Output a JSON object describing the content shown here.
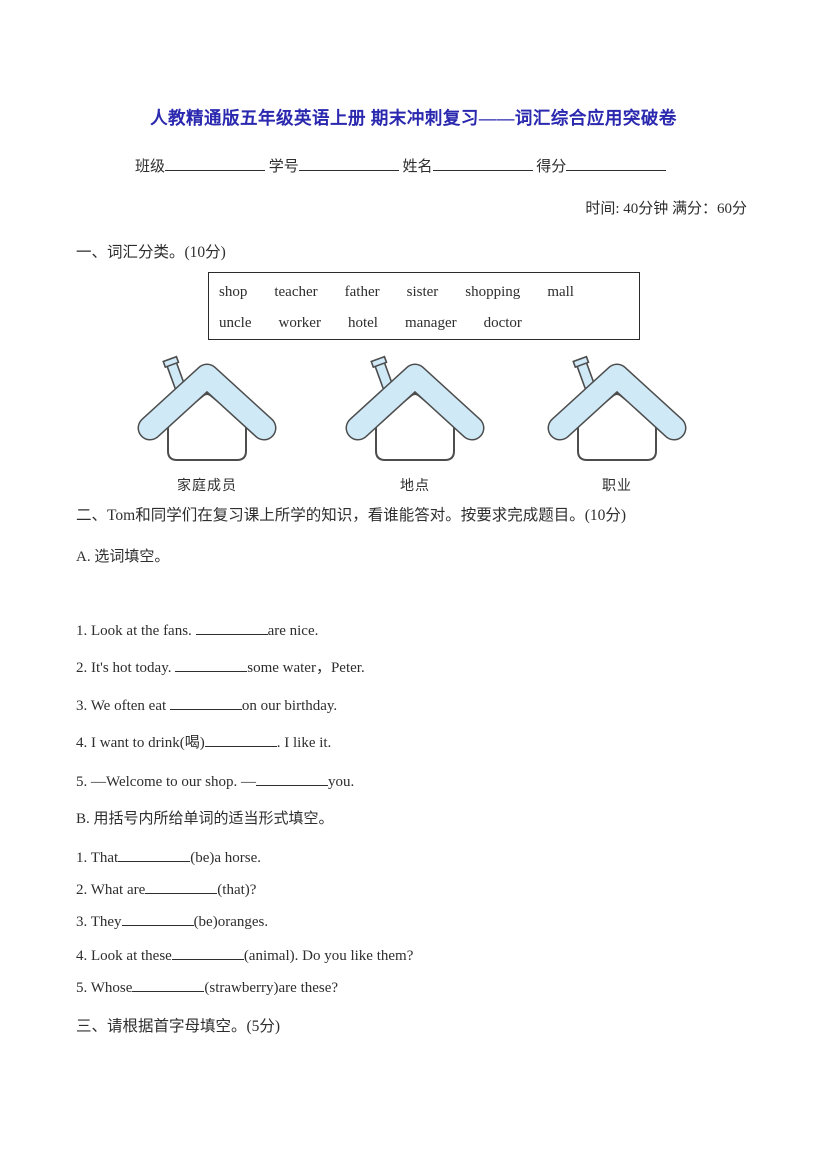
{
  "page": {
    "title": "人教精通版五年级英语上册 期末冲刺复习——词汇综合应用突破卷",
    "meta": "时间: 40分钟 满分：60分",
    "fields": {
      "class": "班级",
      "student_no": "学号",
      "name": "姓名",
      "score": "得分"
    }
  },
  "section1": {
    "heading": "一、词汇分类。(10分)",
    "wordbank": {
      "row1": [
        "shop",
        "teacher",
        "father",
        "sister",
        "shopping",
        "mall"
      ],
      "row2": [
        "uncle",
        "worker",
        "hotel",
        "manager",
        "doctor"
      ]
    },
    "categories": [
      "家庭成员",
      "地点",
      "职业"
    ],
    "house_style": {
      "roof_color": "#cfe9f7",
      "outline_color": "#4d4d4d",
      "body_color": "#ffffff"
    }
  },
  "section2": {
    "heading": "二、Tom和同学们在复习课上所学的知识，看谁能答对。按要求完成题目。(10分)",
    "partA": {
      "heading": "A. 选词填空。",
      "questions": [
        {
          "pre": "1. Look at the fans. ",
          "post": "are nice."
        },
        {
          "pre": "2. It's hot today. ",
          "post": "some water，Peter."
        },
        {
          "pre": "3. We often eat ",
          "post": "on our birthday."
        },
        {
          "pre": "4. I want to drink(喝)",
          "post": ". I like it."
        },
        {
          "pre": "5. —Welcome to our shop. —",
          "post": "you."
        }
      ]
    },
    "partB": {
      "heading": "B. 用括号内所给单词的适当形式填空。",
      "questions": [
        {
          "pre": "1. That",
          "post": "(be)a horse."
        },
        {
          "pre": "2. What are",
          "post": "(that)?"
        },
        {
          "pre": "3. They",
          "post": "(be)oranges."
        },
        {
          "pre": "4. Look at these",
          "post": "(animal). Do you like them?"
        },
        {
          "pre": "5. Whose",
          "post": "(strawberry)are these?"
        }
      ]
    }
  },
  "section3": {
    "heading": "三、请根据首字母填空。(5分)"
  }
}
